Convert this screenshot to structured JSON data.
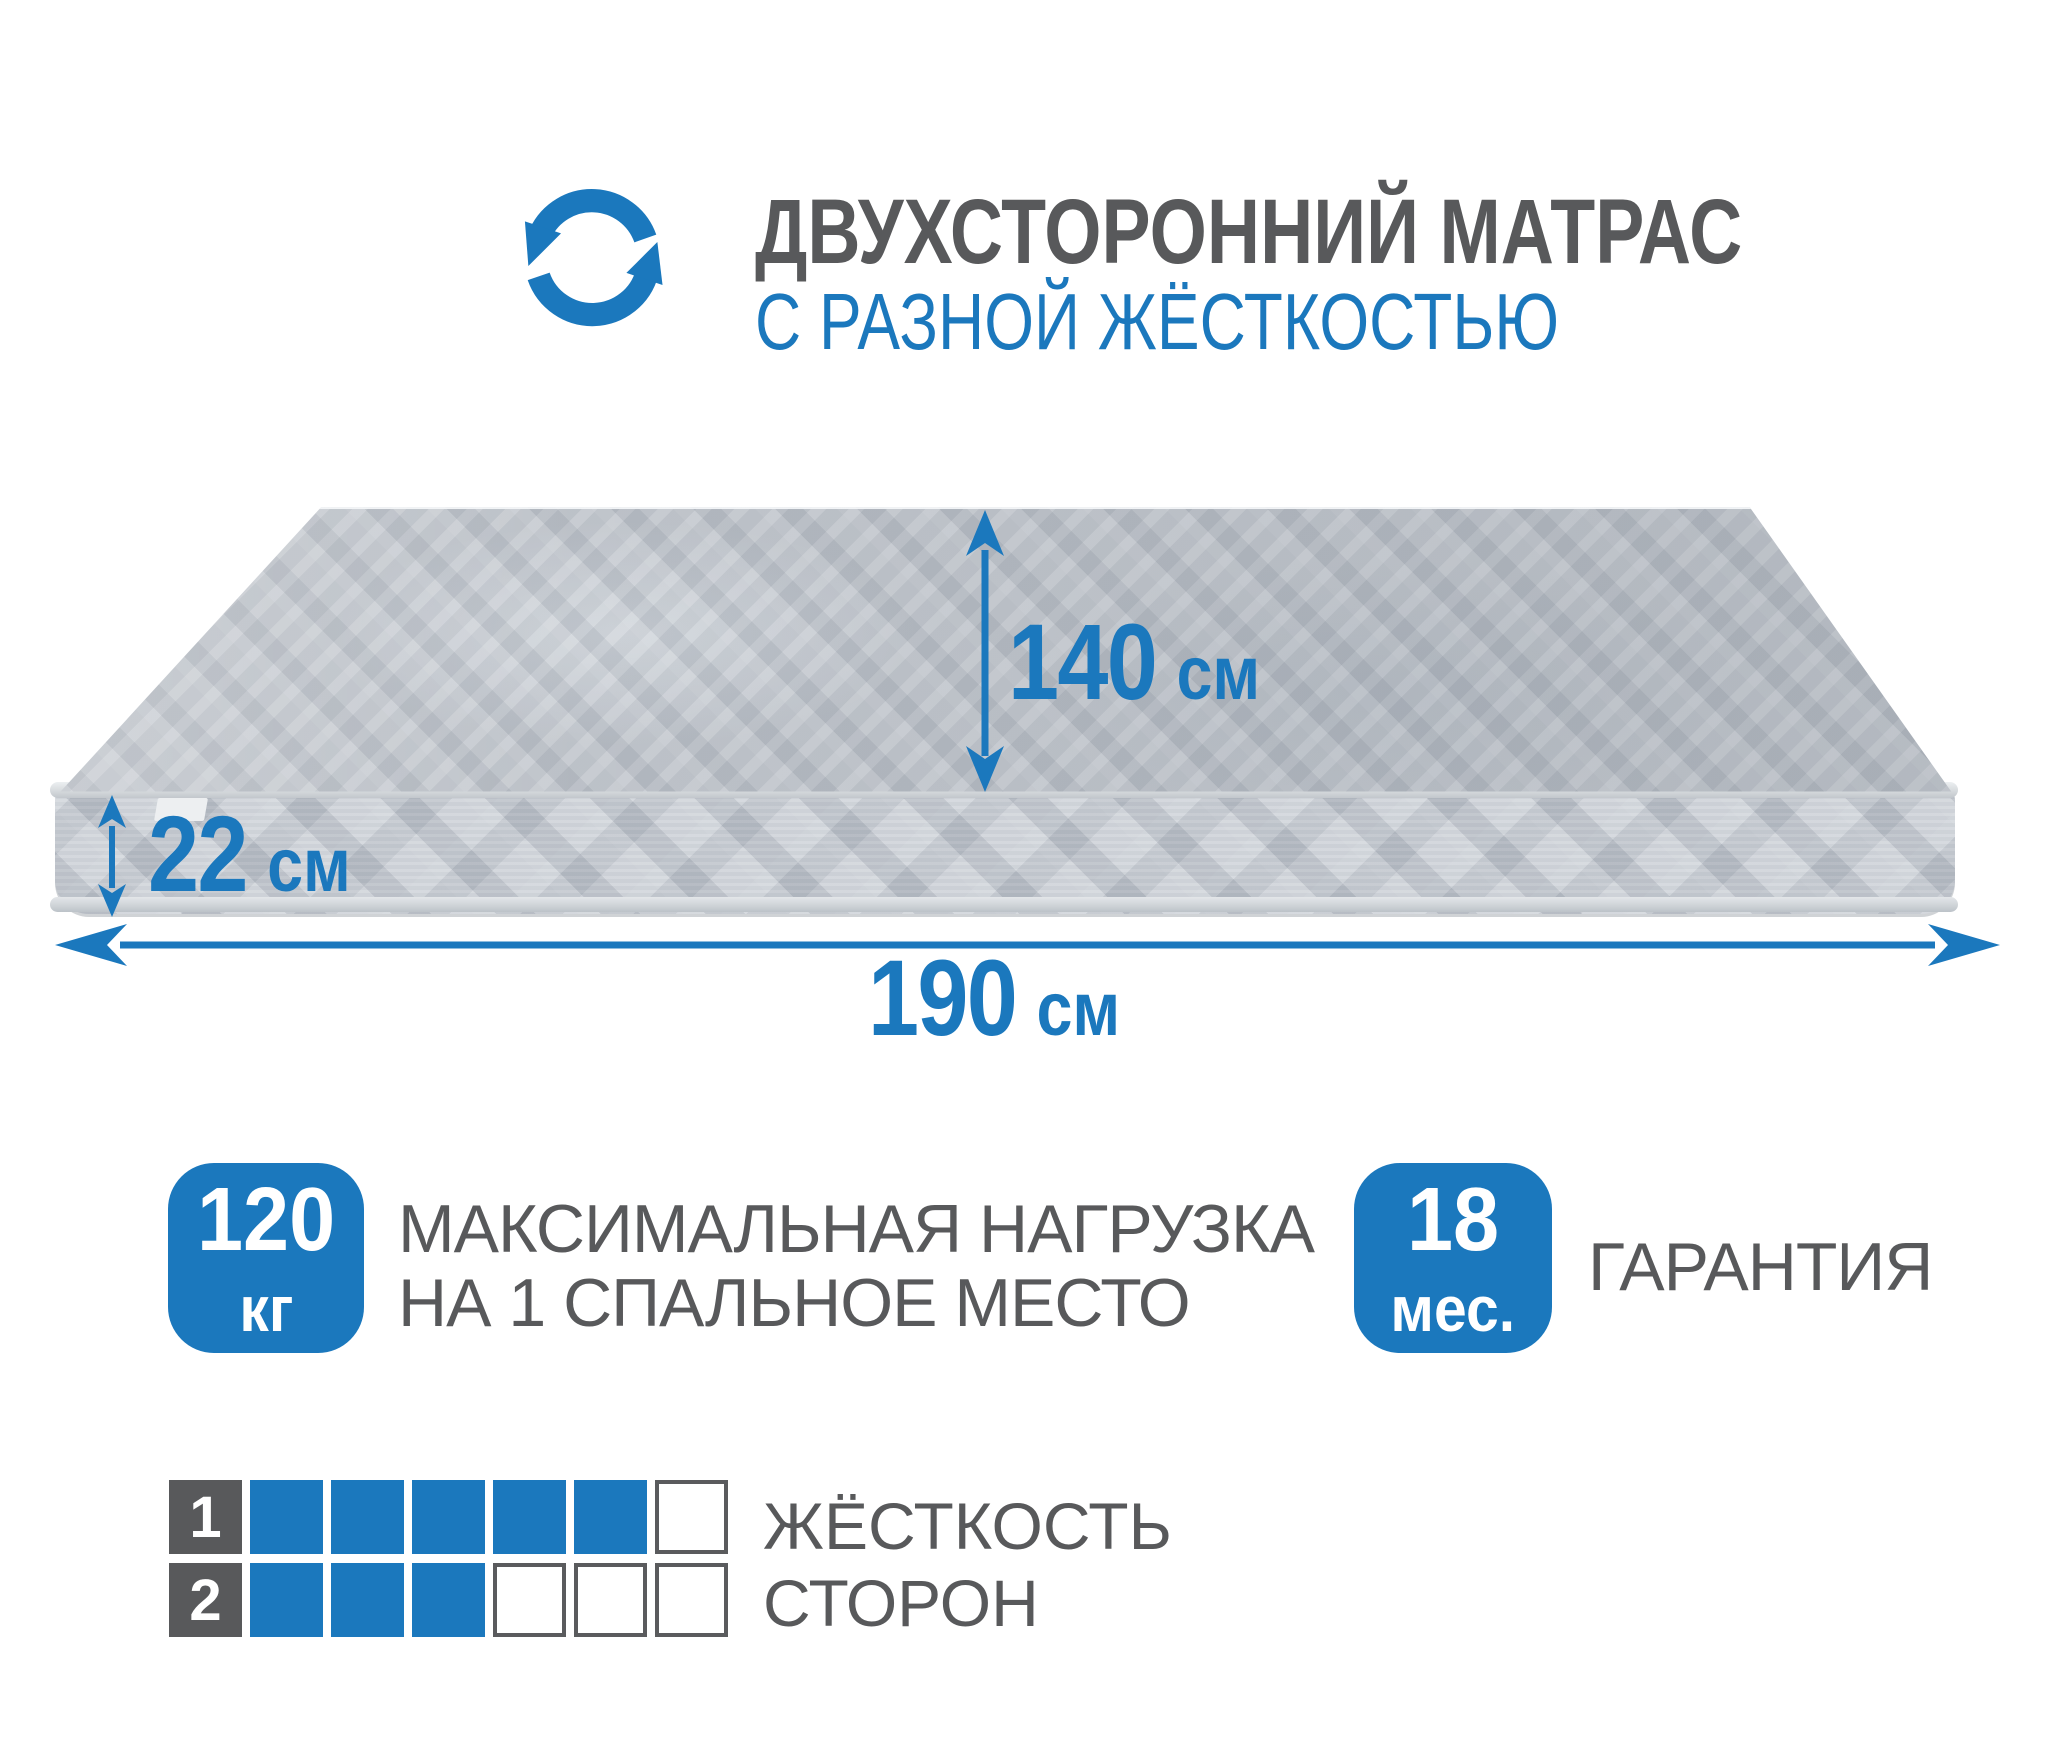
{
  "header": {
    "icon": "rotate-flip-icon",
    "title": "ДВУХСТОРОННИЙ МАТРАС",
    "subtitle": "С РАЗНОЙ ЖЁСТКОСТЬЮ"
  },
  "mattress": {
    "width": {
      "value": "140",
      "unit": "см"
    },
    "thickness": {
      "value": "22",
      "unit": "см"
    },
    "length": {
      "value": "190",
      "unit": "см"
    }
  },
  "features": {
    "max_load": {
      "badge_value": "120",
      "badge_unit": "кг",
      "label_line1": "МАКСИМАЛЬНАЯ НАГРУЗКА",
      "label_line2": "НА 1 СПАЛЬНОЕ МЕСТО"
    },
    "warranty": {
      "badge_value": "18",
      "badge_unit": "мес.",
      "label": "ГАРАНТИЯ"
    }
  },
  "firmness": {
    "caption_line1": "ЖЁСТКОСТЬ",
    "caption_line2": "СТОРОН",
    "rows": [
      {
        "label": "1",
        "filled": 5,
        "total": 6
      },
      {
        "label": "2",
        "filled": 3,
        "total": 6
      }
    ]
  },
  "colors": {
    "accent_blue": "#1b78bd",
    "text_gray": "#58595b",
    "fabric_top": "#bdc2c9",
    "fabric_side": "#c6cbd2"
  }
}
